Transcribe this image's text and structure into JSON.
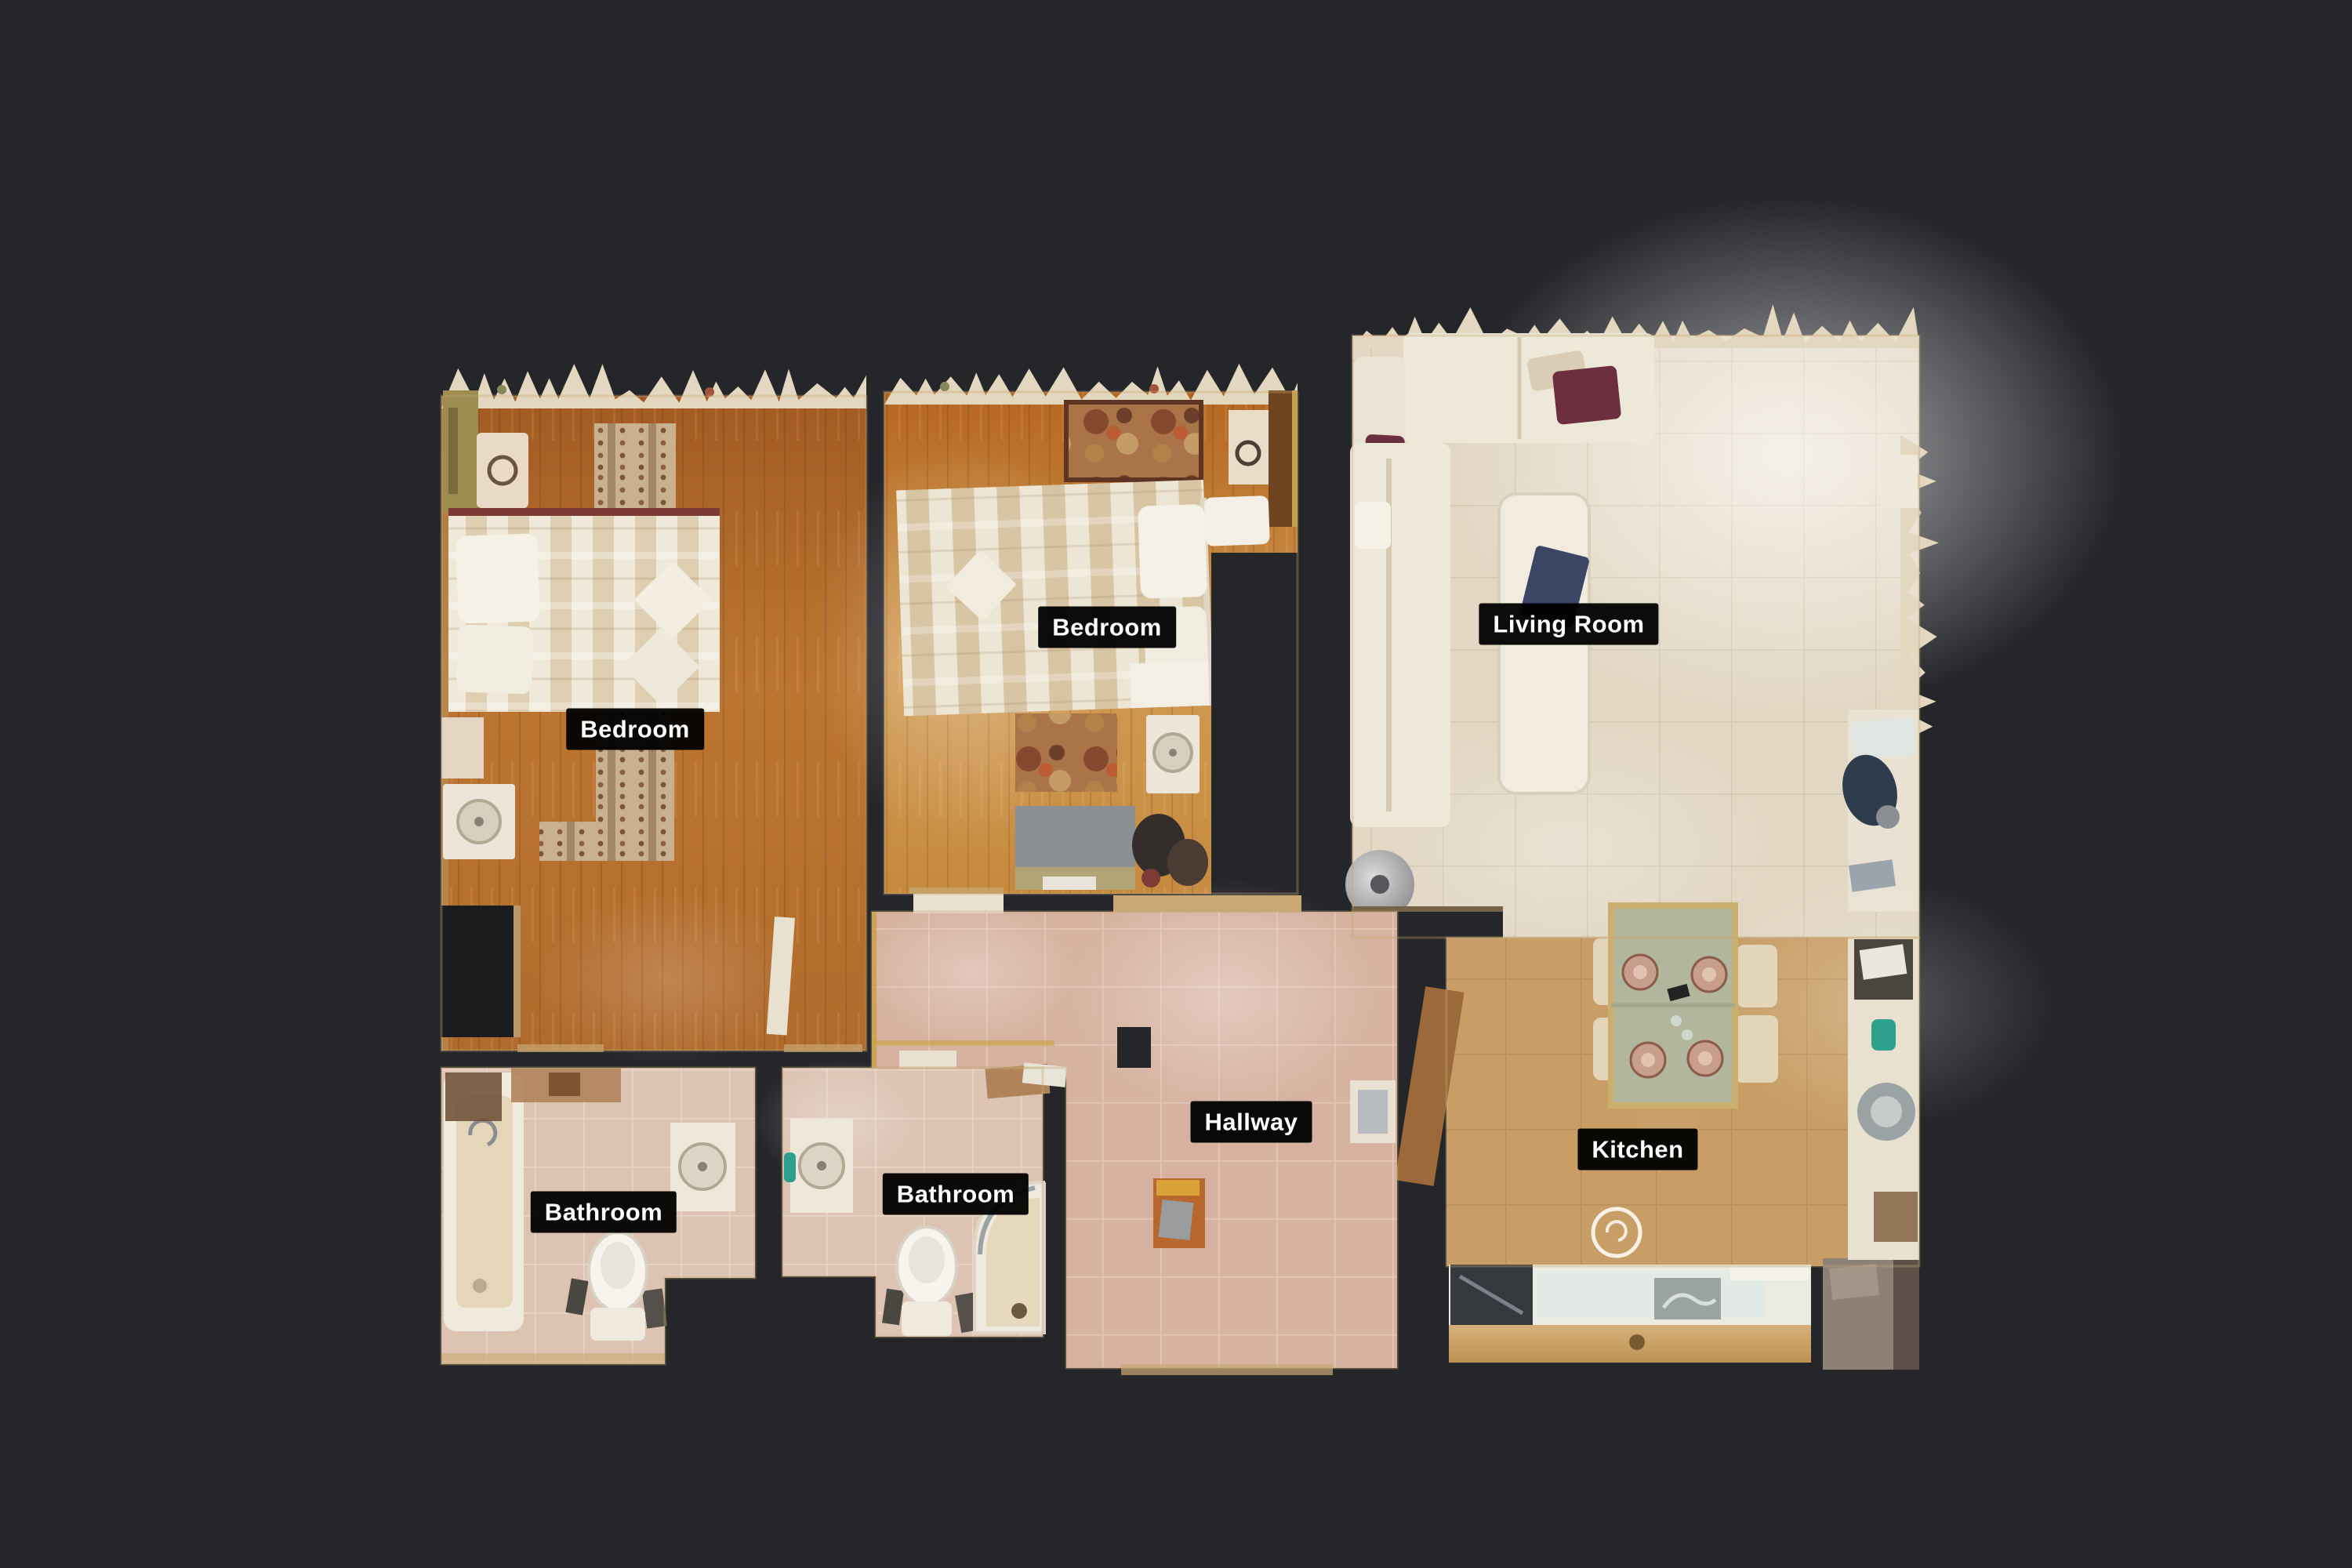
{
  "app": {
    "name": "3d-floorplan-viewer",
    "view_mode": "floorplan-top-down",
    "background_color": "#25262a"
  },
  "floorplan": {
    "rooms": [
      {
        "id": "bedroom-1",
        "label": "Bedroom"
      },
      {
        "id": "bedroom-2",
        "label": "Bedroom"
      },
      {
        "id": "living-room",
        "label": "Living Room"
      },
      {
        "id": "hallway",
        "label": "Hallway"
      },
      {
        "id": "bathroom-1",
        "label": "Bathroom"
      },
      {
        "id": "bathroom-2",
        "label": "Bathroom"
      },
      {
        "id": "kitchen",
        "label": "Kitchen"
      }
    ],
    "label_style": {
      "background": "#000000",
      "text_color": "#ffffff"
    },
    "palette": {
      "bedroom1_wood": "#b06a2c",
      "bedroom2_wood": "#c8883c",
      "living_tile": "#e2d7c3",
      "kitchen_tile": "#c89e66",
      "hallway_tile": "#d7b2a0",
      "bathroom_tile": "#dcc3b2",
      "cut_wall_edge": "#e3d8bf",
      "wall_trim_tan": "#c9a873",
      "accent_maroon": "#6b2f3d",
      "accent_blue": "#3a4663",
      "accent_teal": "#2ea08e"
    },
    "markers": [
      {
        "id": "panorama-marker",
        "room": "kitchen",
        "shape": "ring"
      }
    ]
  }
}
